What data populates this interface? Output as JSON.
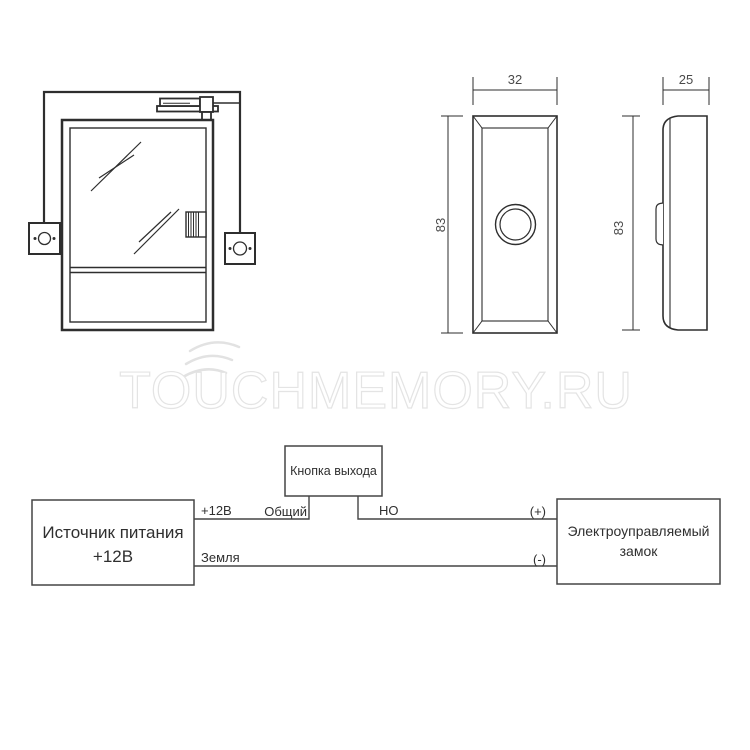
{
  "watermark": {
    "text": "TOUCHMEMORY.RU",
    "color": "#e4e4e4"
  },
  "button_views": {
    "front": {
      "width_label": "32",
      "height_label": "83"
    },
    "side": {
      "width_label": "25",
      "height_label": "83"
    }
  },
  "wiring_diagram": {
    "power_supply": {
      "line1": "Источник питания",
      "line2": "+12В"
    },
    "exit_button": {
      "label": "Кнопка выхода"
    },
    "lock": {
      "line1": "Электроуправляемый",
      "line2": "замок"
    },
    "wire_labels": {
      "plus_12v": "+12В",
      "common": "Общий",
      "normally_open": "НО",
      "plus": "(+)",
      "ground": "Земля",
      "minus": "(-)"
    }
  },
  "colors": {
    "line_dark": "#2e2e2e",
    "line_medium": "#454545",
    "background": "#ffffff"
  }
}
